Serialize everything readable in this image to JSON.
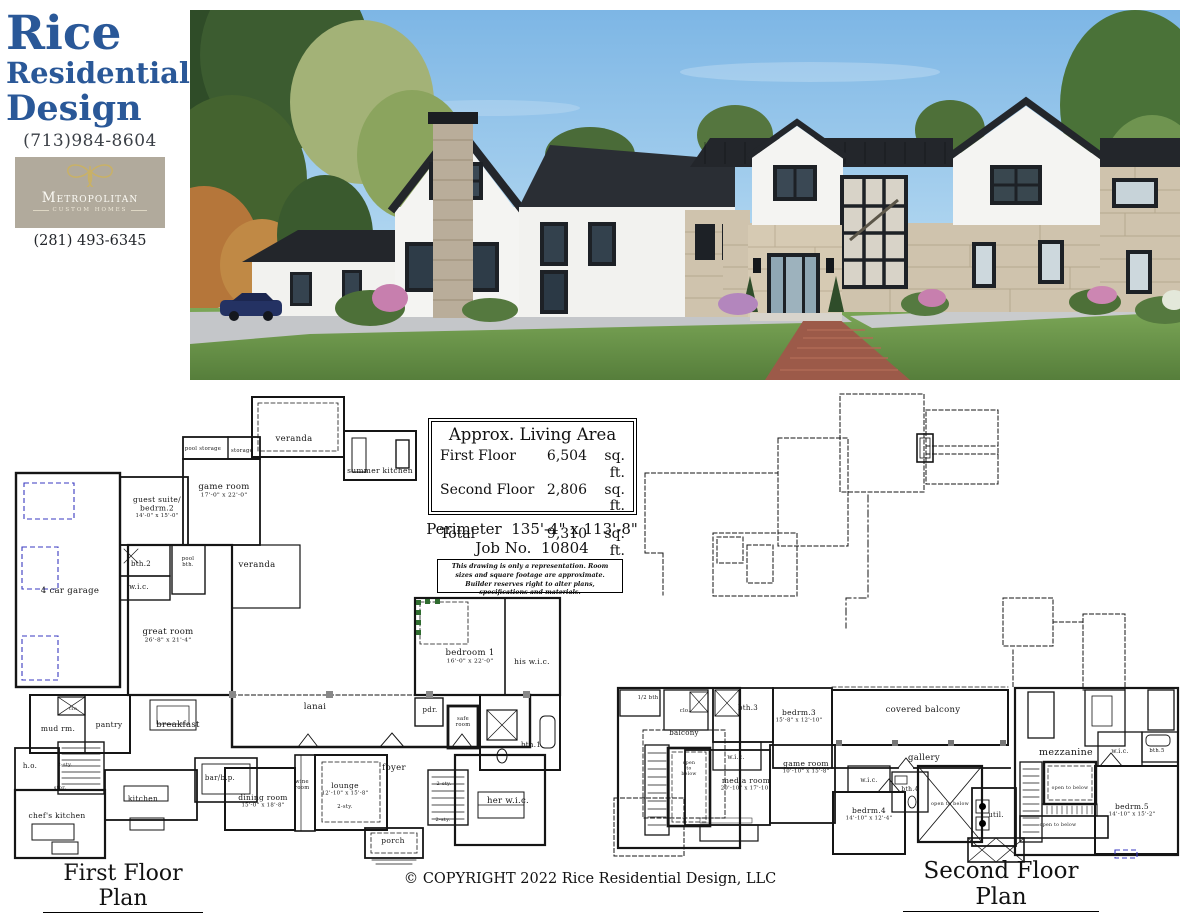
{
  "brand": {
    "name_line1": "Rice",
    "name_line2": "Residential",
    "name_line3": "Design",
    "phone": "(713)984-8604",
    "builder_name": "Metropolitan",
    "builder_tagline": "CUSTOM HOMES",
    "builder_phone": "(281) 493-6345",
    "accent_color": "#2a5898",
    "builder_bg_color": "#b1aa9c",
    "builder_gold": "#c9b166"
  },
  "living_area": {
    "title": "Approx. Living Area",
    "rows": [
      {
        "label": "First Floor",
        "value": "6,504",
        "unit": "sq. ft."
      },
      {
        "label": "Second Floor",
        "value": "2,806",
        "unit": "sq. ft."
      },
      {
        "label": "Total",
        "value": "9,310",
        "unit": "sq. ft."
      }
    ],
    "perimeter_label": "Perimeter",
    "perimeter_value": "135'-4\" x 113'-8\"",
    "job_label": "Job No.",
    "job_value": "10804",
    "disclaimer": "This drawing is only a representation. Room sizes and square footage are approximate. Builder reserves right to alter plans, specifications and materials."
  },
  "first_floor": {
    "title": "First Floor Plan",
    "rooms": [
      {
        "label": "veranda",
        "x": 294,
        "y": 441
      },
      {
        "label": "summer kitchen",
        "x": 380,
        "y": 473,
        "fs": 7.5
      },
      {
        "label": "pool storage",
        "x": 203,
        "y": 450,
        "fs": 5.2
      },
      {
        "label": "storage",
        "x": 242,
        "y": 452,
        "fs": 5.2
      },
      {
        "label": "game room",
        "dims": "17'-0\" x 22'-0\"",
        "x": 224,
        "y": 489
      },
      {
        "label": "guest suite/",
        "label2": "bedrm.2",
        "dims": "14'-0\" x 15'-0\"",
        "x": 157,
        "y": 502,
        "fs": 7.5
      },
      {
        "label": "bth.2",
        "x": 141,
        "y": 566,
        "fs": 7
      },
      {
        "label": "w.i.c.",
        "x": 139,
        "y": 589,
        "fs": 7
      },
      {
        "label": "pool",
        "label2": "bth.",
        "x": 188,
        "y": 560,
        "fs": 5.2
      },
      {
        "label": "4 car garage",
        "x": 70,
        "y": 593
      },
      {
        "label": "great room",
        "dims": "26'-8\" x 21'-4\"",
        "x": 168,
        "y": 634
      },
      {
        "label": "veranda",
        "x": 257,
        "y": 567
      },
      {
        "label": "bedroom 1",
        "dims": "16'-0\" x 22'-0\"",
        "x": 470,
        "y": 655
      },
      {
        "label": "his w.i.c.",
        "x": 532,
        "y": 664,
        "fs": 7.5
      },
      {
        "label": "lanai",
        "x": 315,
        "y": 709
      },
      {
        "label": "pdr.",
        "x": 430,
        "y": 712,
        "fs": 7
      },
      {
        "label": "safe",
        "label2": "room",
        "x": 463,
        "y": 720,
        "fs": 5.2
      },
      {
        "label": "bth.1",
        "x": 531,
        "y": 747,
        "fs": 7
      },
      {
        "label": "mud rm.",
        "x": 58,
        "y": 731,
        "fs": 7.5
      },
      {
        "label": "clo.",
        "x": 74,
        "y": 710,
        "fs": 5
      },
      {
        "label": "pantry",
        "x": 109,
        "y": 727,
        "fs": 7.5
      },
      {
        "label": "breakfast",
        "x": 178,
        "y": 727
      },
      {
        "label": "h.o.",
        "x": 30,
        "y": 768,
        "fs": 7
      },
      {
        "label": "2-sty.",
        "x": 65,
        "y": 766,
        "fs": 5
      },
      {
        "label": "stor.",
        "x": 60,
        "y": 789,
        "fs": 5
      },
      {
        "label": "chef's kitchen",
        "x": 57,
        "y": 818,
        "fs": 7.5
      },
      {
        "label": "kitchen",
        "x": 143,
        "y": 801,
        "fs": 7.5
      },
      {
        "label": "bar/b.p.",
        "x": 220,
        "y": 780,
        "fs": 7
      },
      {
        "label": "dining room",
        "dims": "15'-0\" x 18'-8\"",
        "x": 263,
        "y": 800,
        "fs": 7.5
      },
      {
        "label": "wine",
        "label2": "room",
        "x": 302,
        "y": 783,
        "fs": 5.2
      },
      {
        "label": "lounge",
        "dims": "12'-10\" x 15'-8\"",
        "x": 345,
        "y": 788,
        "fs": 7.5
      },
      {
        "label": "2-sty.",
        "x": 345,
        "y": 808,
        "fs": 5.2
      },
      {
        "label": "foyer",
        "x": 394,
        "y": 770
      },
      {
        "label": "2-sty.",
        "x": 444,
        "y": 785,
        "fs": 5
      },
      {
        "label": "2-sty.",
        "x": 443,
        "y": 821,
        "fs": 5
      },
      {
        "label": "her w.i.c.",
        "x": 508,
        "y": 803
      },
      {
        "label": "porch",
        "x": 393,
        "y": 843,
        "fs": 7.5
      }
    ]
  },
  "second_floor": {
    "title": "Second Floor Plan",
    "rooms": [
      {
        "label": "1/2 bth",
        "x": 648,
        "y": 699,
        "fs": 5.2
      },
      {
        "label": "clo.",
        "x": 685,
        "y": 712,
        "fs": 5.2
      },
      {
        "label": "bth.3",
        "x": 748,
        "y": 710,
        "fs": 7
      },
      {
        "label": "bedrm.3",
        "dims": "15'-8\" x 12'-10\"",
        "x": 799,
        "y": 715,
        "fs": 7.5
      },
      {
        "label": "w.i.c.",
        "x": 736,
        "y": 759,
        "fs": 6
      },
      {
        "label": "balcony",
        "x": 684,
        "y": 735,
        "fs": 7
      },
      {
        "label": "open",
        "label2": "to",
        "label3": "below",
        "x": 689,
        "y": 764,
        "fs": 4.6
      },
      {
        "label": "covered balcony",
        "x": 923,
        "y": 712
      },
      {
        "label": "gallery",
        "x": 924,
        "y": 760
      },
      {
        "label": "game room",
        "dims": "10'-10\" x 15'-8\"",
        "x": 806,
        "y": 766,
        "fs": 7.5
      },
      {
        "label": "media room",
        "dims": "20'-10\" x 17'-10\"",
        "x": 746,
        "y": 783,
        "fs": 7.5
      },
      {
        "label": "w.i.c.",
        "x": 869,
        "y": 782,
        "fs": 6
      },
      {
        "label": "bth.4",
        "x": 910,
        "y": 791,
        "fs": 6
      },
      {
        "label": "bedrm.4",
        "dims": "14'-10\" x 12'-4\"",
        "x": 869,
        "y": 813,
        "fs": 7.5
      },
      {
        "label": "open to below",
        "x": 950,
        "y": 805,
        "fs": 4.8
      },
      {
        "label": "util.",
        "x": 996,
        "y": 817,
        "fs": 7
      },
      {
        "label": "mezzanine",
        "x": 1066,
        "y": 755,
        "fs": 9.5
      },
      {
        "label": "w.i.c.",
        "x": 1120,
        "y": 753,
        "fs": 6
      },
      {
        "label": "bth.5",
        "x": 1157,
        "y": 752,
        "fs": 5.2
      },
      {
        "label": "open to below",
        "x": 1070,
        "y": 789,
        "fs": 4.6
      },
      {
        "label": "bedrm.5",
        "dims": "14'-10\" x 15'-2\"",
        "x": 1132,
        "y": 809,
        "fs": 7.5
      },
      {
        "label": "open to below",
        "x": 1058,
        "y": 826,
        "fs": 4.6
      }
    ]
  },
  "footer": {
    "copyright": "© COPYRIGHT 2022 Rice Residential Design, LLC"
  }
}
